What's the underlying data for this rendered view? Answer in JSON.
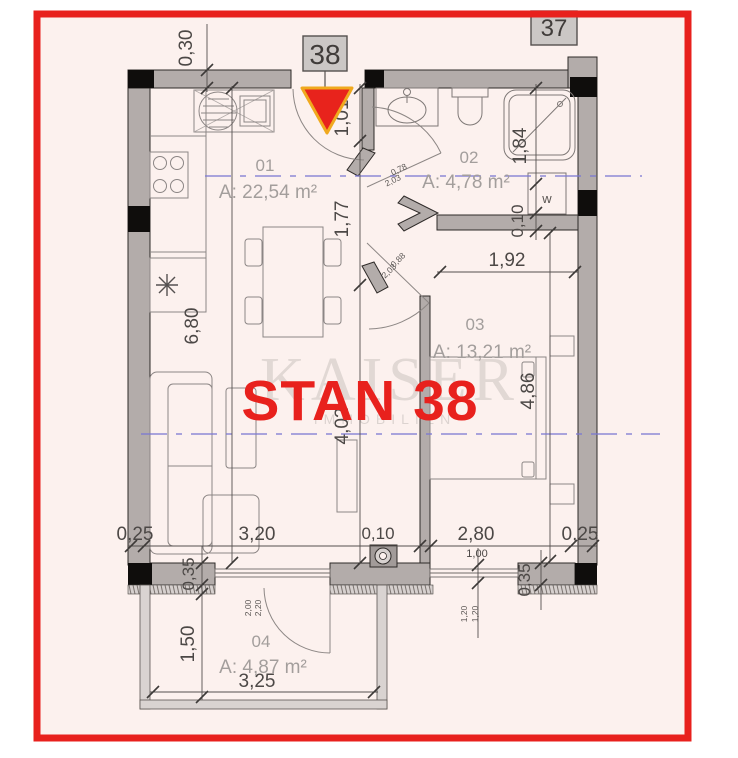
{
  "badges": {
    "unit": "38",
    "adjacent_unit": "37"
  },
  "title": "STAN 38",
  "watermark": {
    "brand": "KAISER",
    "sub": "IMMOBILIEN"
  },
  "rooms": {
    "r1": {
      "no": "01",
      "area": "A: 22,54 m²"
    },
    "r2": {
      "no": "02",
      "area": "A: 4,78 m²"
    },
    "r3": {
      "no": "03",
      "area": "A: 13,21 m²"
    },
    "r4": {
      "no": "04",
      "area": "A: 4,87 m²"
    }
  },
  "fixtures": {
    "washer": "w"
  },
  "dims": {
    "top_wall": "0,30",
    "entry": "1,01",
    "axis_upper": "1,77",
    "axis_lower": "4,02",
    "kitchen_side": "6,80",
    "shower_len": "1,84",
    "bath_wall": "0,10",
    "bedroom_top": "1,92",
    "bedroom_side": "4,86",
    "bottom_left_wall": "0,25",
    "living_width": "3,20",
    "bottom_mid_wall": "0,10",
    "bedroom_width": "2,80",
    "bottom_right_wall": "0,25",
    "window_width": "1,00",
    "window_pane_a": "1,20",
    "window_pane_b": "1,20",
    "bedroom_parapet": "0,35",
    "balcony_parapet": "0,35",
    "balcony_depth": "1,50",
    "balcony_width": "3,25",
    "bath_door_w": "0,78",
    "bath_door_h": "2,03",
    "bedroom_door_w": "0,88",
    "bedroom_door_h": "2,03",
    "balcony_door_a": "2,00",
    "balcony_door_b": "2,20"
  },
  "colors": {
    "frame_red": "#e8211d",
    "title_red": "#e8211d",
    "triangle_red": "#e8231c",
    "triangle_border": "#f0a91e",
    "axis_blue": "#7b78d4",
    "wall_gray": "#b3acaa",
    "plan_bg": "#fcf1ee"
  }
}
